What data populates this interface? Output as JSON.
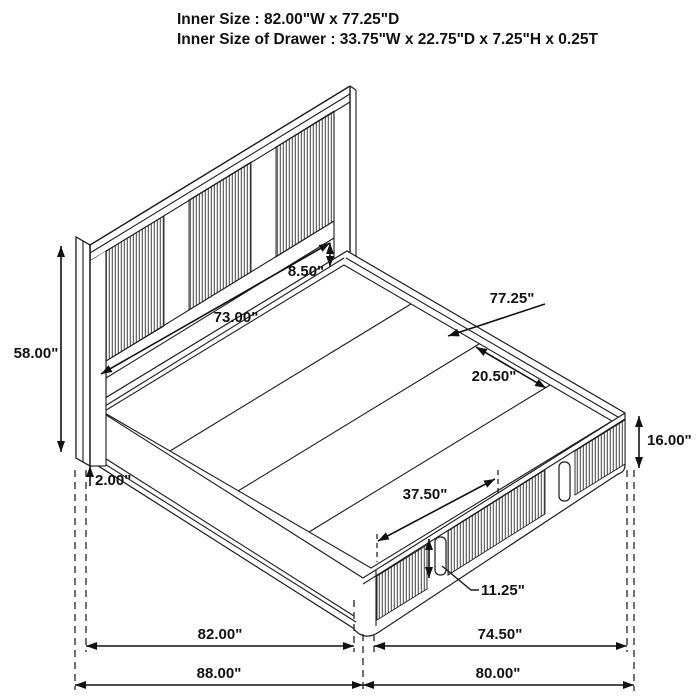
{
  "title": {
    "line1": "Inner Size : 82.00\"W x 77.25\"D",
    "line2": "Inner Size of Drawer : 33.75\"W x 22.75\"D x 7.25\"H x 0.25T"
  },
  "dims": {
    "headboard_height": "58.00\"",
    "panel_width": "73.00\"",
    "headboard_gap": "8.50\"",
    "bed_inner_depth": "77.25\"",
    "slat_width": "20.50\"",
    "floor_clearance": "2.00\"",
    "footboard_height": "16.00\"",
    "drawer_width": "37.50\"",
    "handle_height": "11.25\"",
    "side_inner_length": "82.00\"",
    "side_outer_length": "88.00\"",
    "foot_inner_width": "74.50\"",
    "foot_outer_width": "80.00\""
  },
  "colors": {
    "line": "#1b1b1b",
    "rib": "#4a4a4a",
    "background": "#ffffff"
  }
}
